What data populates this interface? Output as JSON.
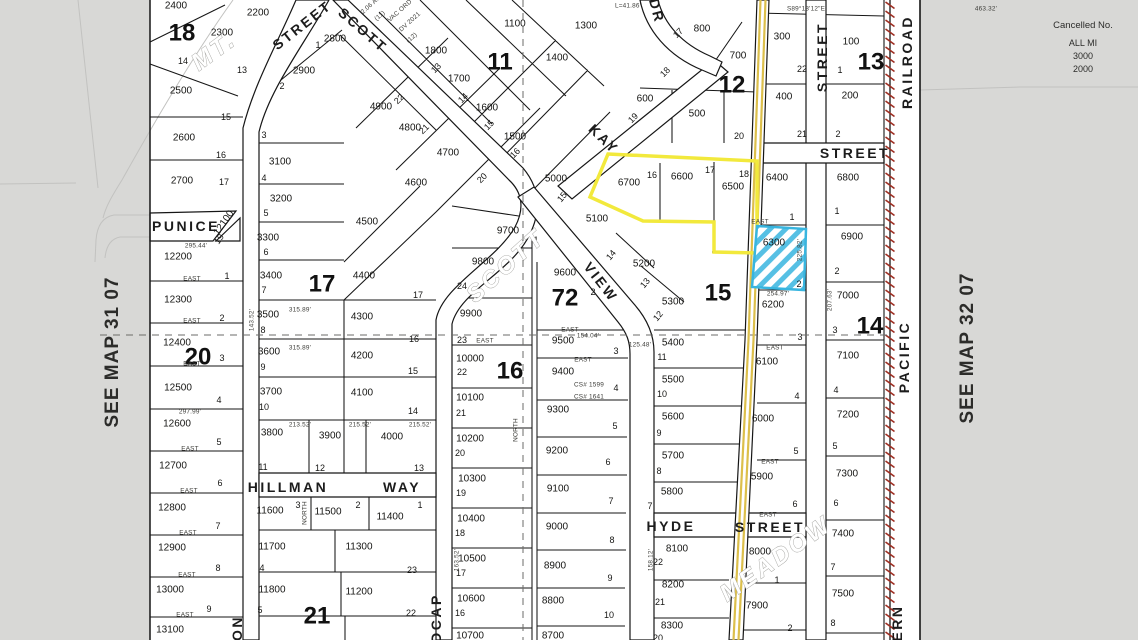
{
  "title": "Assessor plat map section 72",
  "margins": {
    "left": "SEE MAP 31 07",
    "right": "SEE MAP 32 07"
  },
  "cancelled": {
    "title": "Cancelled No.",
    "lines": [
      "ALL MI",
      "3000",
      "2000"
    ]
  },
  "colors": {
    "background": "#d8d8d6",
    "paper": "#ffffff",
    "line": "#161616",
    "highlight_yellow": "#f2e93c",
    "road_yellow": "#dcbf4b",
    "highlight_blue": "#38b5df",
    "railroad_red": "#9e2f23",
    "outline_text": "#9d9d99",
    "dashed": "#6b6b68"
  },
  "highlights": {
    "yellow_outline": {
      "points": "608,154 757,161 757,253 714,252 714,222 643,221 590,197"
    },
    "blue_parcel": {
      "points": "757,226 806,229 804,290 752,287",
      "parcel": "6300"
    },
    "yellow_road_d1": "M760.5,0 L748.5,340 L733.5,640",
    "yellow_road_d2": "M765.5,0 L753.5,340 L738.5,640"
  },
  "block_numbers": [
    {
      "t": "18",
      "x": 182,
      "y": 33
    },
    {
      "t": "11",
      "x": 500,
      "y": 62
    },
    {
      "t": "12",
      "x": 732,
      "y": 85
    },
    {
      "t": "13",
      "x": 871,
      "y": 62
    },
    {
      "t": "17",
      "x": 322,
      "y": 284
    },
    {
      "t": "72",
      "x": 565,
      "y": 298,
      "s": 46
    },
    {
      "t": "15",
      "x": 718,
      "y": 293
    },
    {
      "t": "14",
      "x": 870,
      "y": 326
    },
    {
      "t": "16",
      "x": 510,
      "y": 371
    },
    {
      "t": "20",
      "x": 198,
      "y": 357
    },
    {
      "t": "21",
      "x": 317,
      "y": 616
    }
  ],
  "street_names": [
    {
      "t": "STREET",
      "x": 302,
      "y": 25,
      "r": -38
    },
    {
      "t": "SCOTT",
      "x": 363,
      "y": 30,
      "r": 41
    },
    {
      "t": "KAY",
      "x": 604,
      "y": 139,
      "r": 44,
      "s": 13
    },
    {
      "t": "DR",
      "x": 657,
      "y": 11,
      "r": 75,
      "s": 13
    },
    {
      "t": "VIEW",
      "x": 601,
      "y": 282,
      "r": 52
    },
    {
      "t": "PUNICE",
      "x": 186,
      "y": 226,
      "s": 12
    },
    {
      "t": "HILLMAN",
      "x": 288,
      "y": 487
    },
    {
      "t": "WAY",
      "x": 402,
      "y": 487
    },
    {
      "t": "HYDE",
      "x": 671,
      "y": 526
    },
    {
      "t": "STREET",
      "x": 770,
      "y": 527
    },
    {
      "t": "STREET",
      "x": 822,
      "y": 57,
      "r": -90,
      "s": 13
    },
    {
      "t": "STREET",
      "x": 855,
      "y": 153,
      "s": 13
    },
    {
      "t": "RAILROAD",
      "x": 907,
      "y": 62,
      "r": -90
    },
    {
      "t": "PACIFIC",
      "x": 904,
      "y": 357,
      "r": -90
    },
    {
      "t": "ERN",
      "x": 897,
      "y": 623,
      "r": -90,
      "s": 13
    },
    {
      "t": "ON",
      "x": 237,
      "y": 628,
      "r": -90,
      "s": 12
    },
    {
      "t": "DCAP",
      "x": 436,
      "y": 618,
      "r": -90,
      "s": 12
    }
  ],
  "outline_names": [
    {
      "t": "MT.",
      "x": 214,
      "y": 51,
      "r": -36,
      "s": 19
    },
    {
      "t": "SCOTT",
      "x": 506,
      "y": 266,
      "r": -42,
      "s": 27
    },
    {
      "t": "MEADOW",
      "x": 776,
      "y": 559,
      "r": -35,
      "s": 22
    }
  ],
  "parcel_numbers": [
    {
      "t": "2400",
      "x": 176,
      "y": 6
    },
    {
      "t": "2300",
      "x": 222,
      "y": 33
    },
    {
      "t": "2200",
      "x": 258,
      "y": 13
    },
    {
      "t": "2500",
      "x": 181,
      "y": 91
    },
    {
      "t": "2600",
      "x": 184,
      "y": 138
    },
    {
      "t": "2700",
      "x": 182,
      "y": 181
    },
    {
      "t": "2800",
      "x": 335,
      "y": 39
    },
    {
      "t": "2900",
      "x": 304,
      "y": 71
    },
    {
      "t": "3100",
      "x": 280,
      "y": 162
    },
    {
      "t": "3200",
      "x": 281,
      "y": 199
    },
    {
      "t": "3300",
      "x": 268,
      "y": 238
    },
    {
      "t": "3400",
      "x": 271,
      "y": 276
    },
    {
      "t": "3500",
      "x": 268,
      "y": 315
    },
    {
      "t": "3600",
      "x": 269,
      "y": 352
    },
    {
      "t": "3700",
      "x": 271,
      "y": 392
    },
    {
      "t": "3800",
      "x": 272,
      "y": 433
    },
    {
      "t": "3900",
      "x": 330,
      "y": 436
    },
    {
      "t": "4000",
      "x": 392,
      "y": 437
    },
    {
      "t": "4100",
      "x": 362,
      "y": 393
    },
    {
      "t": "4200",
      "x": 362,
      "y": 356
    },
    {
      "t": "4300",
      "x": 362,
      "y": 317
    },
    {
      "t": "4400",
      "x": 364,
      "y": 276
    },
    {
      "t": "4500",
      "x": 367,
      "y": 222
    },
    {
      "t": "4600",
      "x": 416,
      "y": 183
    },
    {
      "t": "4700",
      "x": 448,
      "y": 153
    },
    {
      "t": "4800",
      "x": 410,
      "y": 128
    },
    {
      "t": "4900",
      "x": 381,
      "y": 107
    },
    {
      "t": "1100",
      "x": 515,
      "y": 24
    },
    {
      "t": "1300",
      "x": 586,
      "y": 26
    },
    {
      "t": "1400",
      "x": 557,
      "y": 58
    },
    {
      "t": "1500",
      "x": 515,
      "y": 137
    },
    {
      "t": "1600",
      "x": 487,
      "y": 108
    },
    {
      "t": "1700",
      "x": 459,
      "y": 79
    },
    {
      "t": "1800",
      "x": 436,
      "y": 51
    },
    {
      "t": "800",
      "x": 702,
      "y": 29
    },
    {
      "t": "700",
      "x": 738,
      "y": 56
    },
    {
      "t": "600",
      "x": 645,
      "y": 99
    },
    {
      "t": "500",
      "x": 697,
      "y": 114
    },
    {
      "t": "300",
      "x": 782,
      "y": 37
    },
    {
      "t": "400",
      "x": 784,
      "y": 97
    },
    {
      "t": "100",
      "x": 851,
      "y": 42
    },
    {
      "t": "200",
      "x": 850,
      "y": 96
    },
    {
      "t": "6400",
      "x": 777,
      "y": 178
    },
    {
      "t": "6800",
      "x": 848,
      "y": 178
    },
    {
      "t": "6700",
      "x": 629,
      "y": 183
    },
    {
      "t": "6600",
      "x": 682,
      "y": 177
    },
    {
      "t": "6500",
      "x": 733,
      "y": 187
    },
    {
      "t": "5000",
      "x": 556,
      "y": 179
    },
    {
      "t": "5100",
      "x": 597,
      "y": 219
    },
    {
      "t": "5200",
      "x": 644,
      "y": 264
    },
    {
      "t": "5300",
      "x": 673,
      "y": 302
    },
    {
      "t": "6300",
      "x": 774,
      "y": 243
    },
    {
      "t": "6200",
      "x": 773,
      "y": 305
    },
    {
      "t": "6100",
      "x": 767,
      "y": 362
    },
    {
      "t": "6000",
      "x": 763,
      "y": 419
    },
    {
      "t": "5900",
      "x": 762,
      "y": 477
    },
    {
      "t": "5400",
      "x": 673,
      "y": 343
    },
    {
      "t": "5500",
      "x": 673,
      "y": 380
    },
    {
      "t": "5600",
      "x": 673,
      "y": 417
    },
    {
      "t": "5700",
      "x": 673,
      "y": 456
    },
    {
      "t": "5800",
      "x": 672,
      "y": 492
    },
    {
      "t": "6900",
      "x": 852,
      "y": 237
    },
    {
      "t": "7000",
      "x": 848,
      "y": 296
    },
    {
      "t": "7100",
      "x": 848,
      "y": 356
    },
    {
      "t": "7200",
      "x": 848,
      "y": 415
    },
    {
      "t": "7300",
      "x": 847,
      "y": 474
    },
    {
      "t": "7400",
      "x": 843,
      "y": 534
    },
    {
      "t": "7500",
      "x": 843,
      "y": 594
    },
    {
      "t": "9700",
      "x": 508,
      "y": 231
    },
    {
      "t": "9800",
      "x": 483,
      "y": 262
    },
    {
      "t": "9900",
      "x": 471,
      "y": 314
    },
    {
      "t": "9600",
      "x": 565,
      "y": 273
    },
    {
      "t": "9500",
      "x": 563,
      "y": 341
    },
    {
      "t": "9400",
      "x": 563,
      "y": 372
    },
    {
      "t": "9300",
      "x": 558,
      "y": 410
    },
    {
      "t": "9200",
      "x": 557,
      "y": 451
    },
    {
      "t": "9100",
      "x": 558,
      "y": 489
    },
    {
      "t": "9000",
      "x": 557,
      "y": 527
    },
    {
      "t": "8900",
      "x": 555,
      "y": 566
    },
    {
      "t": "8800",
      "x": 553,
      "y": 601
    },
    {
      "t": "8700",
      "x": 553,
      "y": 636
    },
    {
      "t": "10000",
      "x": 470,
      "y": 359
    },
    {
      "t": "10100",
      "x": 470,
      "y": 398
    },
    {
      "t": "10200",
      "x": 470,
      "y": 439
    },
    {
      "t": "10300",
      "x": 472,
      "y": 479
    },
    {
      "t": "10400",
      "x": 471,
      "y": 519
    },
    {
      "t": "10500",
      "x": 472,
      "y": 559
    },
    {
      "t": "10600",
      "x": 471,
      "y": 599
    },
    {
      "t": "10700",
      "x": 470,
      "y": 636
    },
    {
      "t": "12100",
      "x": 224,
      "y": 223,
      "r": -55
    },
    {
      "t": "12200",
      "x": 178,
      "y": 257
    },
    {
      "t": "12300",
      "x": 178,
      "y": 300
    },
    {
      "t": "12400",
      "x": 177,
      "y": 343
    },
    {
      "t": "12500",
      "x": 178,
      "y": 388
    },
    {
      "t": "12600",
      "x": 177,
      "y": 424
    },
    {
      "t": "12700",
      "x": 173,
      "y": 466
    },
    {
      "t": "12800",
      "x": 172,
      "y": 508
    },
    {
      "t": "12900",
      "x": 172,
      "y": 548
    },
    {
      "t": "13000",
      "x": 170,
      "y": 590
    },
    {
      "t": "13100",
      "x": 170,
      "y": 630
    },
    {
      "t": "11600",
      "x": 270,
      "y": 511
    },
    {
      "t": "11500",
      "x": 328,
      "y": 512
    },
    {
      "t": "11400",
      "x": 390,
      "y": 517
    },
    {
      "t": "11700",
      "x": 272,
      "y": 547
    },
    {
      "t": "11300",
      "x": 359,
      "y": 547
    },
    {
      "t": "11800",
      "x": 272,
      "y": 590
    },
    {
      "t": "11200",
      "x": 359,
      "y": 592
    },
    {
      "t": "8100",
      "x": 677,
      "y": 549
    },
    {
      "t": "8200",
      "x": 673,
      "y": 585
    },
    {
      "t": "8300",
      "x": 672,
      "y": 626
    },
    {
      "t": "8000",
      "x": 760,
      "y": 552
    },
    {
      "t": "7900",
      "x": 757,
      "y": 606
    }
  ],
  "lot_numbers": [
    {
      "t": "14",
      "x": 183,
      "y": 61
    },
    {
      "t": "13",
      "x": 242,
      "y": 70
    },
    {
      "t": "15",
      "x": 226,
      "y": 117
    },
    {
      "t": "16",
      "x": 221,
      "y": 155
    },
    {
      "t": "17",
      "x": 224,
      "y": 182
    },
    {
      "t": "1",
      "x": 318,
      "y": 45
    },
    {
      "t": "2",
      "x": 282,
      "y": 86
    },
    {
      "t": "3",
      "x": 264,
      "y": 135
    },
    {
      "t": "4",
      "x": 264,
      "y": 178
    },
    {
      "t": "5",
      "x": 266,
      "y": 213
    },
    {
      "t": "6",
      "x": 266,
      "y": 252
    },
    {
      "t": "7",
      "x": 264,
      "y": 290
    },
    {
      "t": "8",
      "x": 263,
      "y": 330
    },
    {
      "t": "9",
      "x": 263,
      "y": 367
    },
    {
      "t": "10",
      "x": 264,
      "y": 407
    },
    {
      "t": "11",
      "x": 263,
      "y": 467
    },
    {
      "t": "12",
      "x": 320,
      "y": 468
    },
    {
      "t": "13",
      "x": 419,
      "y": 468
    },
    {
      "t": "14",
      "x": 413,
      "y": 411
    },
    {
      "t": "15",
      "x": 413,
      "y": 371
    },
    {
      "t": "16",
      "x": 414,
      "y": 339
    },
    {
      "t": "17",
      "x": 418,
      "y": 295
    },
    {
      "t": "19",
      "x": 219,
      "y": 239,
      "r": -55
    },
    {
      "t": "1",
      "x": 227,
      "y": 276
    },
    {
      "t": "2",
      "x": 222,
      "y": 318
    },
    {
      "t": "3",
      "x": 222,
      "y": 358
    },
    {
      "t": "4",
      "x": 219,
      "y": 400
    },
    {
      "t": "5",
      "x": 219,
      "y": 442
    },
    {
      "t": "6",
      "x": 220,
      "y": 483
    },
    {
      "t": "7",
      "x": 218,
      "y": 526
    },
    {
      "t": "8",
      "x": 218,
      "y": 568
    },
    {
      "t": "9",
      "x": 209,
      "y": 609
    },
    {
      "t": "13",
      "x": 436,
      "y": 68,
      "r": -45
    },
    {
      "t": "14",
      "x": 463,
      "y": 98,
      "r": -45
    },
    {
      "t": "15",
      "x": 489,
      "y": 125,
      "r": -45
    },
    {
      "t": "16",
      "x": 515,
      "y": 153,
      "r": -45
    },
    {
      "t": "20",
      "x": 482,
      "y": 178,
      "r": -45
    },
    {
      "t": "21",
      "x": 424,
      "y": 129,
      "r": -45
    },
    {
      "t": "22",
      "x": 399,
      "y": 99,
      "r": -45
    },
    {
      "t": "17",
      "x": 678,
      "y": 33,
      "r": -45
    },
    {
      "t": "18",
      "x": 665,
      "y": 72,
      "r": -45
    },
    {
      "t": "19",
      "x": 633,
      "y": 118,
      "r": -45
    },
    {
      "t": "20",
      "x": 739,
      "y": 136
    },
    {
      "t": "22",
      "x": 802,
      "y": 69
    },
    {
      "t": "21",
      "x": 802,
      "y": 134
    },
    {
      "t": "1",
      "x": 840,
      "y": 70
    },
    {
      "t": "2",
      "x": 838,
      "y": 134
    },
    {
      "t": "16",
      "x": 652,
      "y": 175
    },
    {
      "t": "17",
      "x": 710,
      "y": 170
    },
    {
      "t": "18",
      "x": 744,
      "y": 174
    },
    {
      "t": "15",
      "x": 562,
      "y": 197,
      "r": -50
    },
    {
      "t": "14",
      "x": 611,
      "y": 255,
      "r": -50
    },
    {
      "t": "13",
      "x": 645,
      "y": 283,
      "r": -50
    },
    {
      "t": "12",
      "x": 658,
      "y": 316,
      "r": -50
    },
    {
      "t": "11",
      "x": 662,
      "y": 357
    },
    {
      "t": "10",
      "x": 662,
      "y": 394
    },
    {
      "t": "9",
      "x": 659,
      "y": 433
    },
    {
      "t": "8",
      "x": 659,
      "y": 471
    },
    {
      "t": "7",
      "x": 650,
      "y": 506
    },
    {
      "t": "1",
      "x": 792,
      "y": 217
    },
    {
      "t": "2",
      "x": 799,
      "y": 284
    },
    {
      "t": "3",
      "x": 800,
      "y": 337
    },
    {
      "t": "4",
      "x": 797,
      "y": 396
    },
    {
      "t": "5",
      "x": 796,
      "y": 451
    },
    {
      "t": "6",
      "x": 795,
      "y": 504
    },
    {
      "t": "1",
      "x": 837,
      "y": 211
    },
    {
      "t": "2",
      "x": 837,
      "y": 271
    },
    {
      "t": "3",
      "x": 835,
      "y": 330
    },
    {
      "t": "4",
      "x": 836,
      "y": 390
    },
    {
      "t": "5",
      "x": 835,
      "y": 446
    },
    {
      "t": "6",
      "x": 836,
      "y": 503
    },
    {
      "t": "7",
      "x": 833,
      "y": 567
    },
    {
      "t": "8",
      "x": 833,
      "y": 623
    },
    {
      "t": "1",
      "x": 536,
      "y": 240
    },
    {
      "t": "24",
      "x": 462,
      "y": 286
    },
    {
      "t": "23",
      "x": 462,
      "y": 340
    },
    {
      "t": "2",
      "x": 593,
      "y": 292
    },
    {
      "t": "22",
      "x": 462,
      "y": 372
    },
    {
      "t": "21",
      "x": 461,
      "y": 413
    },
    {
      "t": "20",
      "x": 460,
      "y": 453
    },
    {
      "t": "19",
      "x": 461,
      "y": 493
    },
    {
      "t": "18",
      "x": 460,
      "y": 533
    },
    {
      "t": "17",
      "x": 461,
      "y": 573
    },
    {
      "t": "16",
      "x": 460,
      "y": 613
    },
    {
      "t": "3",
      "x": 616,
      "y": 351
    },
    {
      "t": "4",
      "x": 616,
      "y": 388
    },
    {
      "t": "5",
      "x": 615,
      "y": 426
    },
    {
      "t": "6",
      "x": 608,
      "y": 462
    },
    {
      "t": "7",
      "x": 611,
      "y": 501
    },
    {
      "t": "8",
      "x": 612,
      "y": 540
    },
    {
      "t": "9",
      "x": 610,
      "y": 578
    },
    {
      "t": "10",
      "x": 609,
      "y": 615
    },
    {
      "t": "3",
      "x": 298,
      "y": 505
    },
    {
      "t": "2",
      "x": 358,
      "y": 505
    },
    {
      "t": "1",
      "x": 420,
      "y": 505
    },
    {
      "t": "4",
      "x": 262,
      "y": 568
    },
    {
      "t": "23",
      "x": 412,
      "y": 570
    },
    {
      "t": "5",
      "x": 260,
      "y": 610
    },
    {
      "t": "22",
      "x": 411,
      "y": 613
    },
    {
      "t": "22",
      "x": 658,
      "y": 562
    },
    {
      "t": "21",
      "x": 660,
      "y": 602
    },
    {
      "t": "20",
      "x": 658,
      "y": 638
    },
    {
      "t": "1",
      "x": 777,
      "y": 580
    },
    {
      "t": "2",
      "x": 790,
      "y": 628
    }
  ],
  "dimension_texts": [
    {
      "t": "S89°13'12\"E",
      "x": 806,
      "y": 9
    },
    {
      "t": "463.32'",
      "x": 986,
      "y": 9
    },
    {
      "t": "L=41.86'",
      "x": 628,
      "y": 6
    },
    {
      "t": "2.06 AC",
      "x": 371,
      "y": 5,
      "r": -42
    },
    {
      "t": "(11)",
      "x": 380,
      "y": 16,
      "r": -42
    },
    {
      "t": "VAC ORD",
      "x": 400,
      "y": 11,
      "r": -42
    },
    {
      "t": "DV 2021",
      "x": 410,
      "y": 22,
      "r": -42
    },
    {
      "t": "(12)",
      "x": 412,
      "y": 38,
      "r": -42
    },
    {
      "t": "CS# 1599",
      "x": 589,
      "y": 385,
      "s": 7.5
    },
    {
      "t": "CS# 1641",
      "x": 589,
      "y": 397,
      "s": 7.5
    },
    {
      "t": "EAST",
      "x": 192,
      "y": 279
    },
    {
      "t": "EAST",
      "x": 192,
      "y": 321
    },
    {
      "t": "EAST",
      "x": 192,
      "y": 364
    },
    {
      "t": "EAST",
      "x": 190,
      "y": 449
    },
    {
      "t": "EAST",
      "x": 189,
      "y": 491
    },
    {
      "t": "EAST",
      "x": 188,
      "y": 533
    },
    {
      "t": "EAST",
      "x": 187,
      "y": 575
    },
    {
      "t": "EAST",
      "x": 185,
      "y": 615
    },
    {
      "t": "295.44'",
      "x": 196,
      "y": 246
    },
    {
      "t": "297.99'",
      "x": 190,
      "y": 412
    },
    {
      "t": "315.89'",
      "x": 300,
      "y": 310
    },
    {
      "t": "315.89'",
      "x": 300,
      "y": 348
    },
    {
      "t": "213.52'",
      "x": 300,
      "y": 425
    },
    {
      "t": "215.52'",
      "x": 360,
      "y": 425
    },
    {
      "t": "215.52'",
      "x": 420,
      "y": 425
    },
    {
      "t": "NORTH",
      "x": 305,
      "y": 513,
      "r": -90
    },
    {
      "t": "NORTH",
      "x": 516,
      "y": 430,
      "r": -90
    },
    {
      "t": "143.52'",
      "x": 252,
      "y": 320,
      "r": -90
    },
    {
      "t": "163.52'",
      "x": 457,
      "y": 560,
      "r": -90
    },
    {
      "t": "158.12'",
      "x": 651,
      "y": 560,
      "r": -90
    },
    {
      "t": "225.82'",
      "x": 800,
      "y": 250,
      "r": -90
    },
    {
      "t": "207.63'",
      "x": 830,
      "y": 300,
      "r": -90
    },
    {
      "t": "EAST",
      "x": 485,
      "y": 341
    },
    {
      "t": "EAST",
      "x": 570,
      "y": 330
    },
    {
      "t": "154.04'",
      "x": 588,
      "y": 336
    },
    {
      "t": "EAST",
      "x": 583,
      "y": 360
    },
    {
      "t": "EAST",
      "x": 760,
      "y": 222
    },
    {
      "t": "254.97'",
      "x": 778,
      "y": 294
    },
    {
      "t": "EAST",
      "x": 775,
      "y": 348
    },
    {
      "t": "EAST",
      "x": 770,
      "y": 462
    },
    {
      "t": "EAST",
      "x": 768,
      "y": 515
    },
    {
      "t": "125.48'",
      "x": 640,
      "y": 345
    }
  ]
}
